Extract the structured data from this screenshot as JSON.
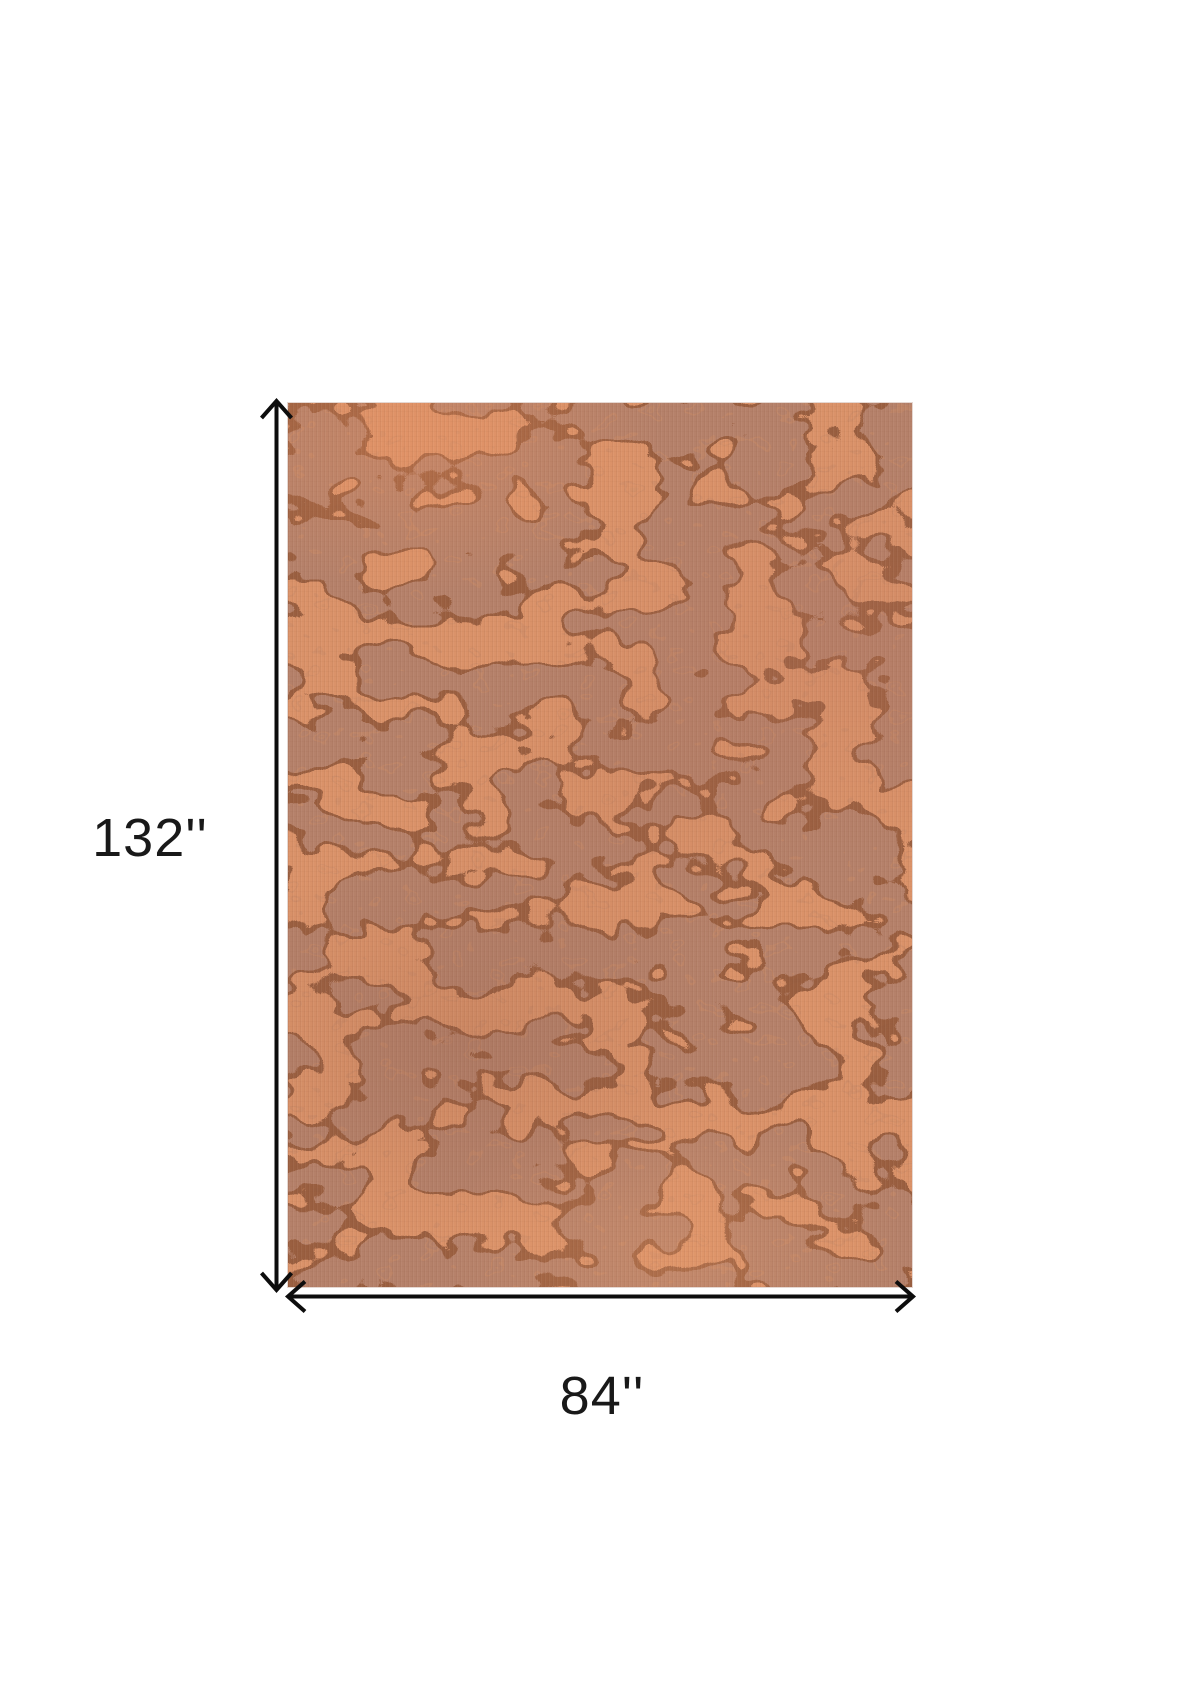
{
  "diagram": {
    "height_label": "132''",
    "width_label": "84''",
    "height_value": 132,
    "width_value": 84,
    "unit_mark": "''",
    "background_color": "#ffffff",
    "arrow_color": "#0d0d0d",
    "label_color": "#191919",
    "rug_colors": {
      "base": "#da9269",
      "patch": "#b5816a",
      "outline": "#8a5336",
      "speckle": "#c98b66"
    }
  }
}
